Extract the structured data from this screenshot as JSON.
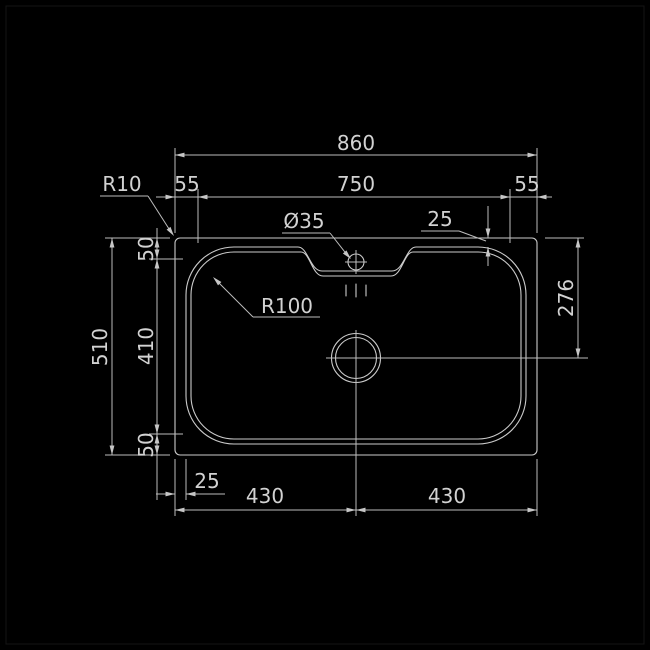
{
  "drawing": {
    "type": "sink-top-view-technical-drawing",
    "colors": {
      "background": "#000000",
      "line": "#cbcbcb",
      "dimension_line": "#bdbdbd",
      "text": "#d2d2d2"
    },
    "dims": {
      "overall_width": "860",
      "bowl_width": "750",
      "margin_left": "55",
      "margin_right": "55",
      "outer_corner_radius": "R10",
      "tap_hole_diameter": "Ø35",
      "rim_offset_top": "25",
      "margin_top": "50",
      "overall_height": "510",
      "bowl_height": "410",
      "margin_bottom": "50",
      "rim_offset_left": "25",
      "drain_offset_left": "430",
      "drain_offset_right": "430",
      "drain_center_from_top": "276",
      "bowl_corner_radius": "R100"
    }
  }
}
